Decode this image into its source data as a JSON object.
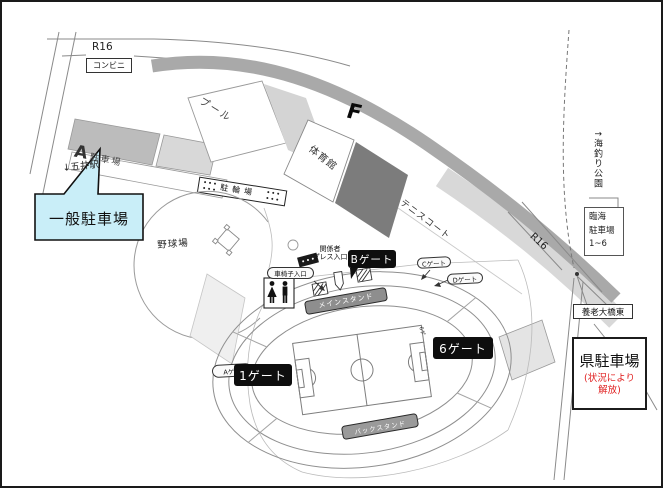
{
  "map": {
    "roads": {
      "r16_top": "R16",
      "r16_right": "R16",
      "goi_station": "↓五井駅",
      "yoro_bridge_east": "養老大橋東"
    },
    "places": {
      "conbini": "コンビニ",
      "pool": "プール",
      "gym": "体育館",
      "tennis": "テニスコート",
      "baseball": "野球場",
      "bicycle": "駐輪場",
      "f_mark": "F",
      "fishing_park": "↑海釣り公園"
    },
    "parking": {
      "a_letter": "A",
      "a_label": "駐車場",
      "general": "一般駐車場",
      "rinkai": "臨海\n駐車場\n1~6",
      "pref_title": "県駐車場",
      "pref_note": "(状況により\n解放)"
    },
    "stadium": {
      "main_stand": "メインスタンド",
      "back_stand": "バックスタンド",
      "away": "AWAY",
      "gate_1": "1ゲート",
      "gate_6": "6ゲート",
      "gate_6_small": "6ゲ",
      "gate_a": "Aゲー",
      "gate_b": "Bゲート",
      "gate_c": "Cゲート",
      "gate_d": "Dゲート",
      "press": "関係者\nプレス入口",
      "wheelchair": "車椅子入口"
    },
    "colors": {
      "callout_fill": "#c9eef8",
      "note_red": "#e02020",
      "dark_block": "#7c7c7c",
      "band_gray": "#a9a9a9",
      "stand_bar_gray": "#8e8e8e",
      "gate_label_bg": "#111111"
    }
  }
}
